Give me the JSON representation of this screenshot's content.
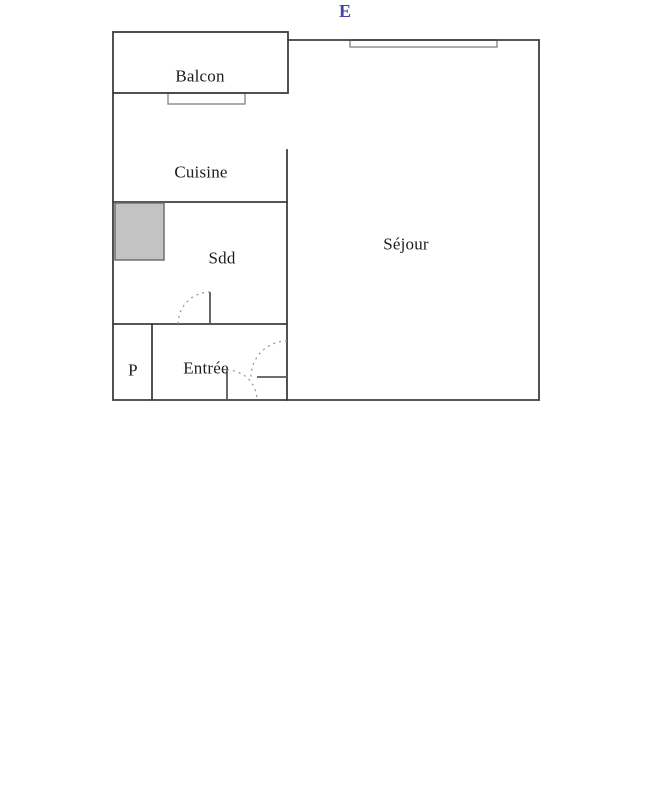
{
  "orientation": {
    "label": "E",
    "color": "#4443ae"
  },
  "rooms": {
    "balcon": {
      "label": "Balcon"
    },
    "cuisine": {
      "label": "Cuisine"
    },
    "sdd": {
      "label": "Sdd"
    },
    "sejour": {
      "label": "Séjour"
    },
    "placard": {
      "label": "P"
    },
    "entree": {
      "label": "Entrée"
    }
  },
  "colors": {
    "background": "#ffffff",
    "wall": "#3e3e3e",
    "window_frame": "#8a8a8a",
    "shower_fill": "#c3c3c3",
    "shower_border": "#6f6f6f",
    "door_leaf": "#5a5a5a",
    "door_swing": "#9a9a9a",
    "text": "#1c1c1c"
  }
}
